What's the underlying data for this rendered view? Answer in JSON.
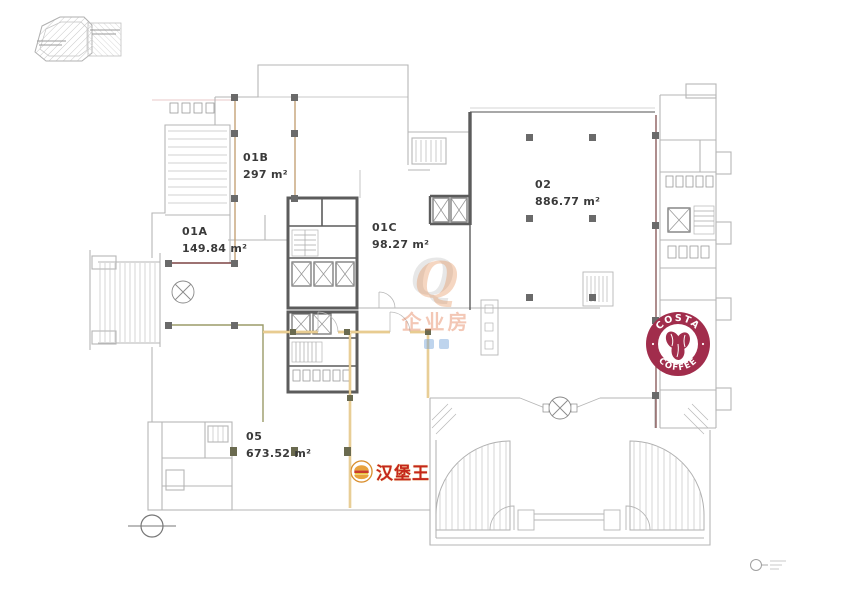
{
  "rooms": {
    "r01a": {
      "number": "01A",
      "area": "149.84 m²"
    },
    "r01b": {
      "number": "01B",
      "area": "297 m²"
    },
    "r01c": {
      "number": "01C",
      "area": "98.27 m²"
    },
    "r02": {
      "number": "02",
      "area": "886.77 m²"
    },
    "r05": {
      "number": "05",
      "area": "673.52 m²"
    }
  },
  "logos": {
    "costa": {
      "top_text": "COSTA",
      "bottom_text": "COFFEE",
      "badge_color": "#a12d4c"
    },
    "burger_king": {
      "text": "汉堡王",
      "text_color": "#c4271c"
    }
  },
  "watermark": {
    "glyph": "Q",
    "text": "企业房",
    "color": "#e4925c"
  },
  "boundary_colors": {
    "tan": "#c4a277",
    "maroon": "#7d4343",
    "olive": "#9b9b68",
    "orange": "#d9ae4f",
    "wall_light": "#b6b6b6",
    "wall_dark": "#5c5c5c"
  }
}
